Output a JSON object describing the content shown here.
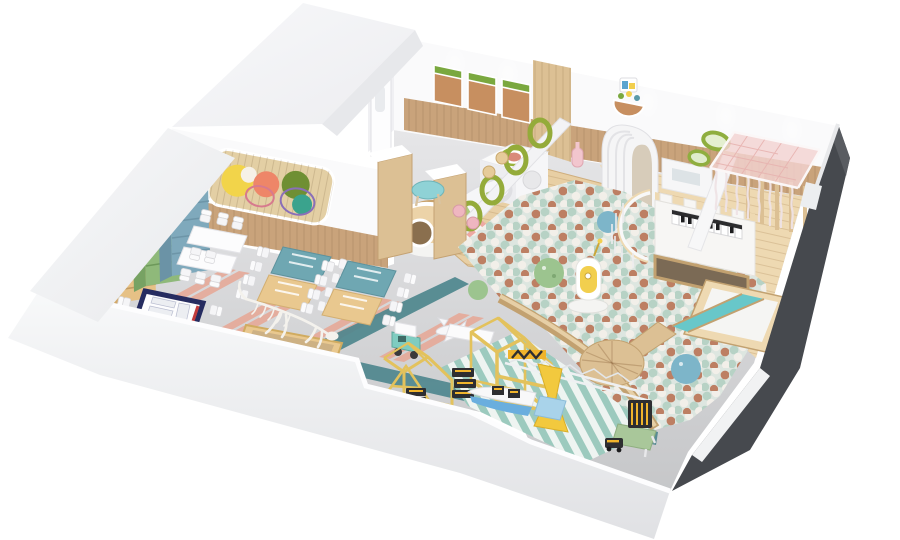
{
  "canvas": {
    "width": 900,
    "height": 540,
    "background": "#ffffff"
  },
  "scene": {
    "description": "Isometric cutaway 3D render of a children's indoor play center floor plan",
    "areas": [
      "classroom-dining-area",
      "play-hall",
      "ball-pit",
      "piano-castle",
      "canopy-sensory-room",
      "construction-play-zone"
    ],
    "objects": [
      "roof-slab",
      "back-wall",
      "cork-boards",
      "arched-door",
      "wall-mural",
      "animal-bookshelves",
      "white-tables",
      "long-desks",
      "navy-play-mat",
      "dinosaur-dig-pit",
      "teal-toy-car",
      "toy-plane",
      "wood-play-deck",
      "cube-climber",
      "tube-slide",
      "barrel-tunnel",
      "ring-climber",
      "arch-tunnel",
      "kids-round-table",
      "ball-pit-balls",
      "textured-balls",
      "duck-robot",
      "round-platform",
      "piano-castle",
      "curved-fence",
      "teal-slide",
      "green-oval-mirrors",
      "pink-canopy",
      "timber-house-frames",
      "crane-truss",
      "yellow-tower",
      "toy-boat",
      "block-toys",
      "green-table",
      "dark-cut-wall",
      "outer-walls"
    ]
  },
  "colors": {
    "roof": "#f3f4f6",
    "roofEdge": "#e7e8eb",
    "wall": "#fafafb",
    "wallShade": "#f0f0f3",
    "outerLight": "#f8f9fa",
    "outerDeep": "#dfe0e3",
    "dark": "#46494e",
    "darkLight": "#595c61",
    "wainscot": "#c9a37b",
    "woodLight": "#eed9b2",
    "woodMid": "#dcc094",
    "woodDark": "#c2a170",
    "deck": "#e8cfa4",
    "floorTop": "#e6e6e8",
    "floorBot": "#c6c7c9",
    "teal": "#4f878e",
    "pink": "#e7a795",
    "mint": "#9ccabe",
    "mintPale": "#eef4f1",
    "cork": "#c78f60",
    "corkGreen": "#7aa83f",
    "mural": "#e3cfa4",
    "ring": "#94ab3a",
    "ballBase": "#dde6e0",
    "ballMint": "#b7d2c5",
    "ballTerr": "#bd7f63",
    "ballWhite": "#f2efe9",
    "slide": "#68c7c9",
    "tblTeal": "#6fa7b2",
    "tblTan": "#e9c88f",
    "bear": "#e6c186",
    "bearSide": "#d2a96b",
    "frog": "#8fb97a",
    "frogSide": "#77a263",
    "cat": "#7fa9bc",
    "catSide": "#6b93a6",
    "navy": "#262c60",
    "canopy": "#f3d3d1",
    "canopyLine": "#e7b3b0",
    "crane": "#f2c93e",
    "frame": "#e3c25c",
    "toyDark": "#2e2e31",
    "toyYel": "#f0b42c",
    "car": "#7fccc0",
    "boat": "#6aaede",
    "boxBlue": "#a9d3ea",
    "duck": "#f2cf4e",
    "grnTbl": "#a9c79a",
    "texGreen": "#9cc48f",
    "texBlue": "#7db5c9",
    "stoolPink": "#efb6c0",
    "kidBlue": "#8fd2d6",
    "bone": "#f4f2ed",
    "barrel": "#ecd3a8",
    "barrelDark": "#c9a36d"
  }
}
